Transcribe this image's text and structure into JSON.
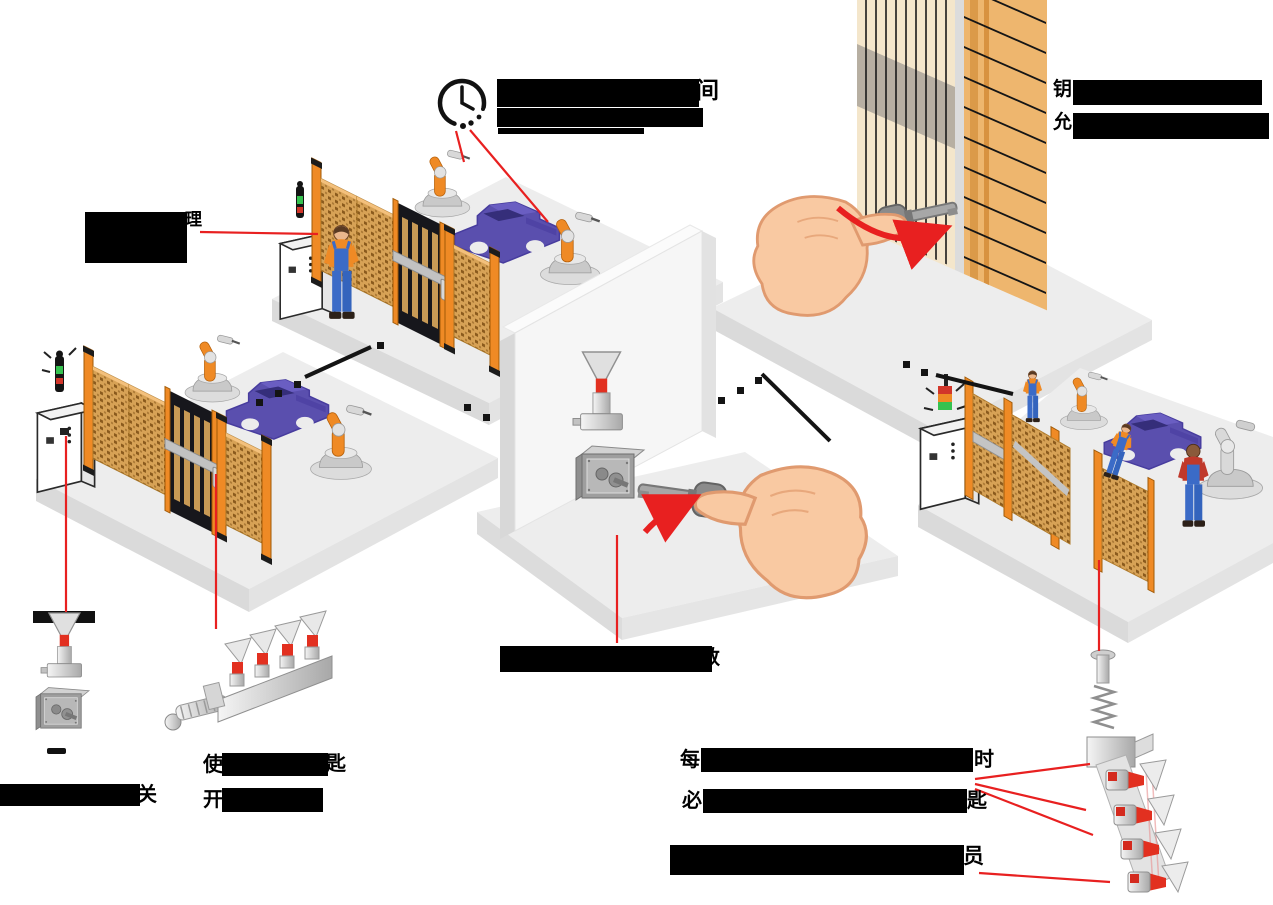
{
  "diagram": {
    "type": "trapped-key-interlock-safety-system-illustration",
    "colors": {
      "callout_red": "#e82020",
      "fence_mesh_tan": "#d7a256",
      "fence_post_orange": "#ef8a25",
      "car_purple": "#5a4fae",
      "platform_gray": "#ededed",
      "redaction_black": "#000000",
      "skin_tone": "#f9c9a2",
      "key_collar_red": "#e23020",
      "wood_wall_cream": "#f4e6cb",
      "wood_wall_orange": "#eeb66e",
      "signal_green": "#35c24f",
      "signal_orange": "#ef8a25",
      "signal_red": "#d2362a"
    },
    "icons": {
      "clock": "clock-icon",
      "key_switch": "key-switch-icon",
      "key_safe_box": "key-safe-box-icon",
      "key_exchange_unit": "key-exchange-unit-icon",
      "key_rack": "key-rack-icon",
      "hand_with_key_upper": "hand-with-key-icon",
      "hand_with_key_center": "hand-with-key-icon"
    },
    "counts": {
      "robot_cells": 3,
      "exchange_unit_keys": 4,
      "key_rack_keys": 4
    },
    "labels": {
      "clock_note": {
        "visible_text": "间",
        "redacted": true
      },
      "wall_note": {
        "line1_visible": "钥",
        "line2_visible": "允",
        "redacted": true
      },
      "cabinet_note": {
        "visible_text": "理",
        "redacted": true
      },
      "switch_note": {
        "visible_text": "关",
        "redacted": true
      },
      "exchange_note": {
        "line1_start": "使",
        "line1_end": "匙",
        "line2_start": "开",
        "redacted": true
      },
      "partition_note": {
        "visible_text": "数",
        "redacted": true
      },
      "rack_note_a": {
        "line1_start": "每",
        "line1_end": "时",
        "line2_start": "必",
        "line2_end": "匙",
        "redacted": true
      },
      "rack_note_b": {
        "visible_text": "员",
        "redacted": true
      }
    }
  }
}
